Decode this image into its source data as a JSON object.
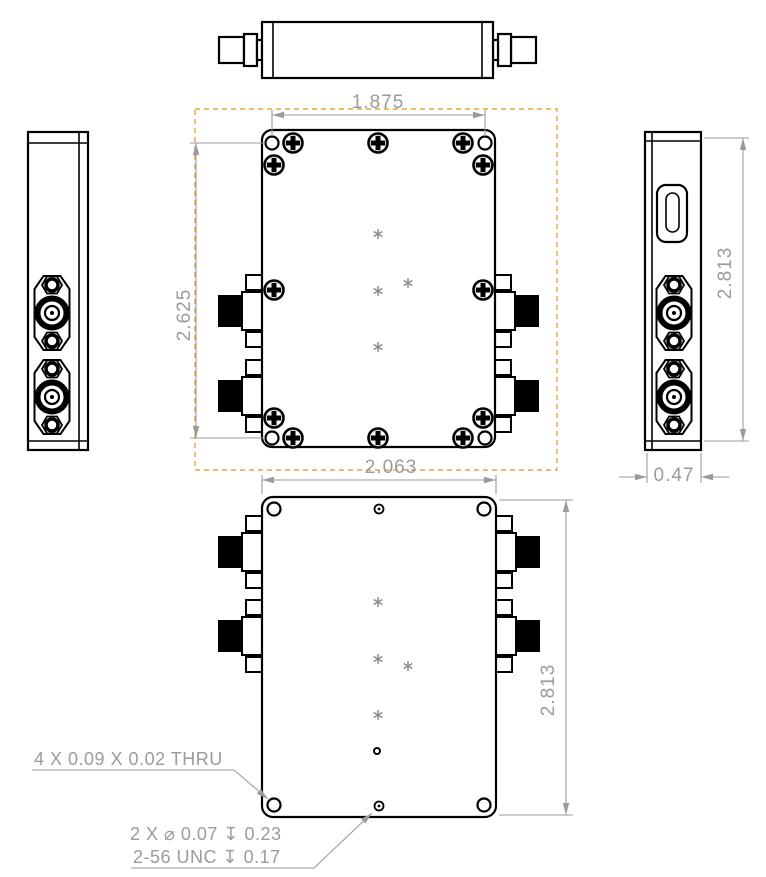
{
  "title": "RF component multi-view engineering drawing",
  "dimensions": {
    "front_hole_span_width": "1.875",
    "front_hole_span_height": "2.625",
    "bottom_body_width": "2.063",
    "side_body_height": "2.813",
    "side_body_depth": "0.47",
    "bottom_body_height": "2.813"
  },
  "annotations": {
    "thru_holes": "4 X 0.09 X 0.02 THRU",
    "tapped_holes_size": "2 X ⌀ 0.07 ↧ 0.23",
    "tapped_holes_thread": "2-56 UNC ↧ 0.17"
  },
  "colors": {
    "line": "#000000",
    "dimension": "#9b9b9b",
    "boundary": "#e8a33d",
    "background": "#ffffff",
    "connector_fill": "#000000",
    "asterisk": "#8c8c8c"
  }
}
